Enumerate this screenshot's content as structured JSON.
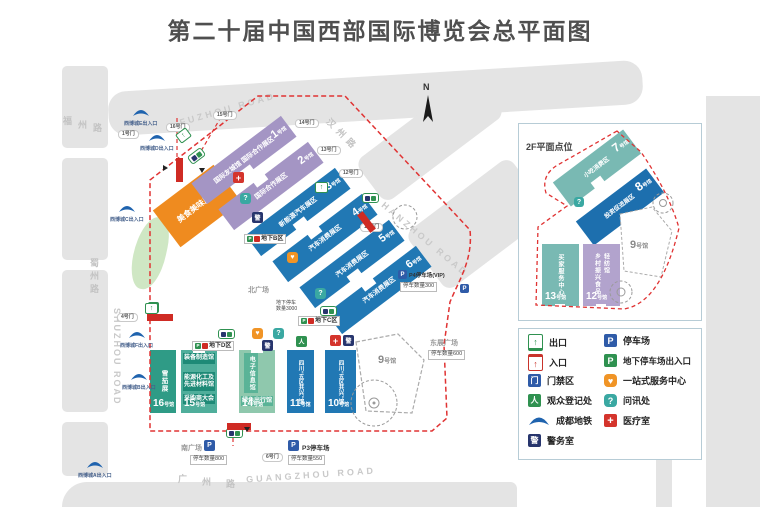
{
  "title": "第二十届中国西部国际博览会总平面图",
  "compass": "N",
  "inset_title": "2F平面点位",
  "roads": {
    "fuzhou_cn1": "福",
    "fuzhou_cn2": "州",
    "fuzhou_cn3": "路",
    "fuzhou_en": "FUZHOU ROAD",
    "shuzhou_cn": "蜀州路",
    "shuzhou_en": "SHUZHOU ROAD",
    "hanzhou_cn": "汉州路",
    "hanzhou_en": "HANZHOU ROAD",
    "guangzhou_cn1": "广",
    "guangzhou_cn2": "州",
    "guangzhou_cn3": "路",
    "guangzhou_en": "GUANGZHOU ROAD"
  },
  "plazas": {
    "north": "北广场",
    "south": "南广场",
    "east": "东展广场"
  },
  "metro": {
    "e": "西博城E出入口",
    "d": "西博城D出入口",
    "c": "西博城C出入口",
    "f": "西博城F出入口",
    "b": "西博城B出入口",
    "a": "西博城A出入口"
  },
  "gates": {
    "g1": "1号门",
    "g16": "16号门",
    "g15": "15号门",
    "g14": "14号门",
    "g13": "13号门",
    "g12": "12号门",
    "g11": "11号门",
    "g6": "6号门",
    "g4": "4号门"
  },
  "halls": {
    "food": {
      "name": "美食美味展区"
    },
    "h1": {
      "no": "1",
      "suffix": "号馆",
      "name": "国际友城馆 国际合作展区"
    },
    "h2": {
      "no": "2",
      "suffix": "号馆",
      "name": "国际合作展区"
    },
    "h3": {
      "no": "3",
      "suffix": "号馆",
      "name": "新能源汽车展区"
    },
    "h4": {
      "no": "4",
      "suffix": "号馆",
      "name": "汽车消费展区"
    },
    "h5": {
      "no": "5",
      "suffix": "号馆",
      "name": "汽车消费展区"
    },
    "h6": {
      "no": "6",
      "suffix": "号馆",
      "name": "汽车消费展区"
    },
    "h7": {
      "no": "7",
      "suffix": "号馆",
      "name": "小吃消费区"
    },
    "h8": {
      "no": "8",
      "suffix": "号馆",
      "name": "投资促进展区"
    },
    "h9": {
      "no": "9",
      "suffix": "号馆"
    },
    "h10": {
      "no": "10",
      "suffix": "号馆",
      "name": "四川“五区共兴”馆"
    },
    "h11": {
      "no": "11",
      "suffix": "号馆",
      "name": "四川“五区共兴”馆"
    },
    "h12": {
      "no": "12",
      "suffix": "号馆",
      "name": "乡村振兴食品轻纺馆"
    },
    "h13": {
      "no": "13",
      "suffix": "号馆",
      "name": "买家服务中心"
    },
    "h14": {
      "no": "14",
      "suffix": "号馆",
      "name": "电子信息馆",
      "name2": "绿色出行馆"
    },
    "h15": {
      "no": "15",
      "suffix": "号馆",
      "name": "装备制造馆",
      "name2": "能源化工及先进材料馆",
      "name3": "采购商大会"
    },
    "h16": {
      "no": "16",
      "suffix": "号馆",
      "name": "雪茄展"
    }
  },
  "underground": {
    "b": "地下B区",
    "c": "地下C区",
    "d": "地下D区",
    "note1": "地下停车",
    "note2": "数量3000"
  },
  "parking": {
    "south_count": "停车数量800",
    "p3_label": "P3停车场",
    "p3_count": "停车数量550",
    "p4_label": "P4停车场(VIP)",
    "p4_count": "停车数量300",
    "east_count": "停车数量600"
  },
  "legend": {
    "left": [
      {
        "label": "出口"
      },
      {
        "label": "入口"
      },
      {
        "label": "门禁区"
      },
      {
        "label": "观众登记处"
      },
      {
        "label": "成都地铁"
      },
      {
        "label": "警务室"
      }
    ],
    "right": [
      {
        "label": "停车场"
      },
      {
        "label": "地下停车场出入口"
      },
      {
        "label": "一站式服务中心"
      },
      {
        "label": "问讯处"
      },
      {
        "label": "医疗室"
      }
    ]
  },
  "glyphs": {
    "up": "↑",
    "plus": "+",
    "q": "?",
    "heart": "♥",
    "p": "P",
    "gate": "门",
    "police": "警",
    "person": "人"
  },
  "colors": {
    "purple": "#a495c4",
    "blue": "#2178b4",
    "teal": "#79b9b3",
    "orange": "#ef8b1f",
    "red": "#d4342c",
    "navy": "#27356d",
    "green": "#2f9150",
    "park_blue": "#2f5ba8",
    "metro": "#1f63ae"
  }
}
